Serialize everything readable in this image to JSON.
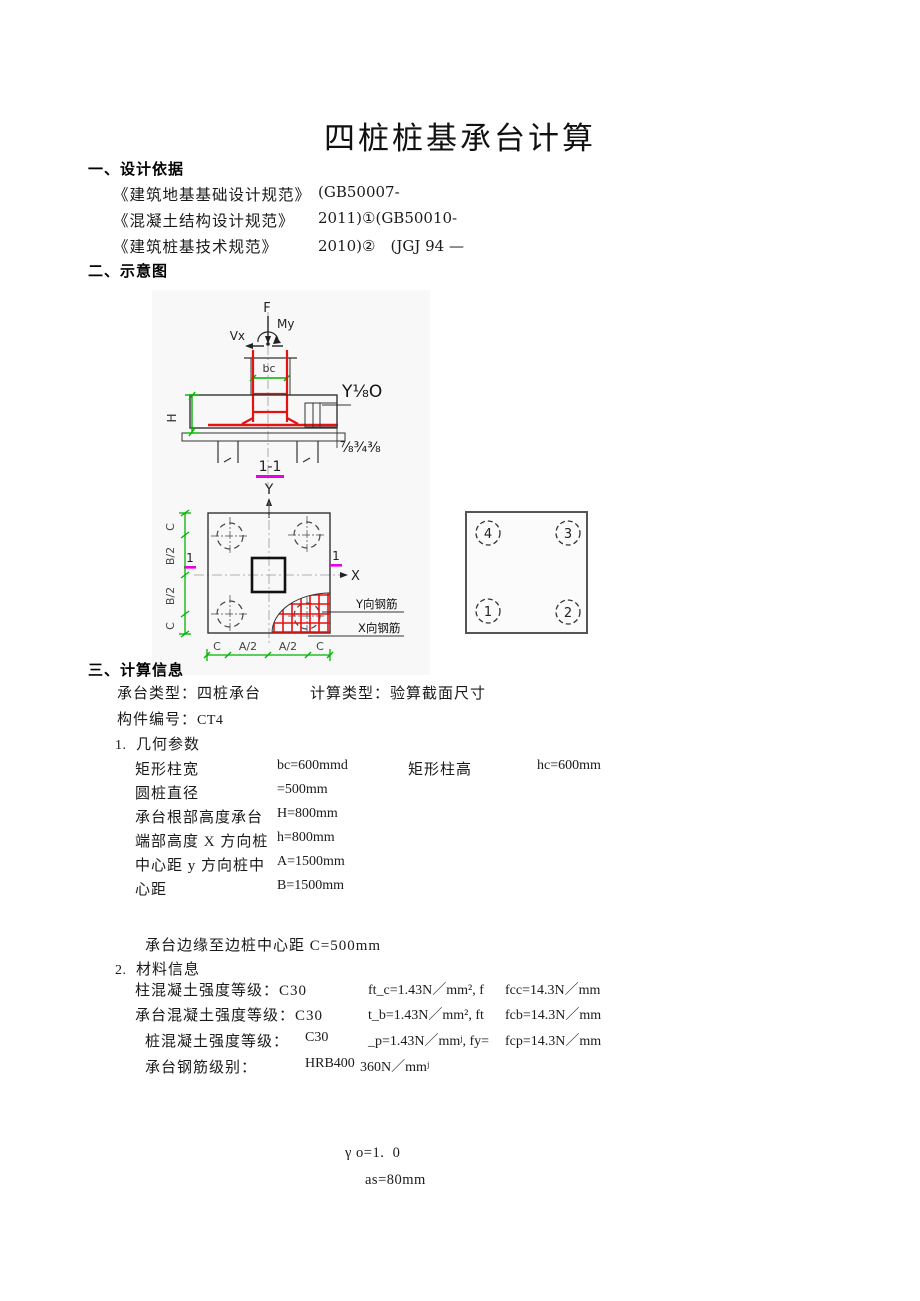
{
  "page": {
    "title": "四桩桩基承台计算"
  },
  "design_basis": {
    "heading": "一、设计依据",
    "references": [
      {
        "name": "《建筑地基基础设计规范》",
        "code": "(GB50007-"
      },
      {
        "name": "《混凝土结构设计规范》",
        "code": "2011)①(GB50010-"
      },
      {
        "name": "《建筑桩基技术规范》",
        "code": "2010)②　(JGJ 94 —"
      }
    ]
  },
  "schematic": {
    "heading": "二、示意图",
    "section_view": {
      "force": "F",
      "moment": "My",
      "shear": "Vx",
      "column_width": "bc",
      "cap_height": "H",
      "note_top": "Y⅛O",
      "note_bottom": "⅞¾⅜",
      "section_mark": "1-1",
      "axis_y": "Y"
    },
    "plan_view": {
      "axis_x": "X",
      "left_dims": [
        "C",
        "B/2",
        "B/2",
        "C"
      ],
      "bottom_dims": [
        "C",
        "A/2",
        "A/2",
        "C"
      ],
      "cut_mark_left": "1",
      "cut_mark_right": "1",
      "rebar_y": "Y向钢筋",
      "rebar_x": "X向钢筋"
    },
    "pile_layout": {
      "top_left": "4",
      "top_right": "3",
      "bottom_left": "1",
      "bottom_right": "2"
    }
  },
  "calc_info": {
    "heading": "三、计算信息",
    "cap_type_label": "承台类型：",
    "cap_type_value": "四桩承台",
    "calc_type_label": "计算类型：",
    "calc_type_value": "验算截面尺寸",
    "member_label": "构件编号：",
    "member_value": "CT4",
    "geometry": {
      "num": "1.",
      "title": "几何参数",
      "rows": [
        {
          "l1": "矩形柱宽",
          "v1": "bc=600mmd",
          "l2": "矩形柱高",
          "v2": "hc=600mm"
        },
        {
          "l1": "圆桩直径",
          "v1": "=500mm",
          "l2": "",
          "v2": ""
        },
        {
          "l1": "承台根部高度承台",
          "v1": "H=800mm",
          "l2": "",
          "v2": ""
        },
        {
          "l1": "端部高度 X 方向桩",
          "v1": "h=800mm",
          "l2": "",
          "v2": ""
        },
        {
          "l1": "中心距 y 方向桩中",
          "v1": "A=1500mm",
          "l2": "",
          "v2": ""
        },
        {
          "l1": "心距",
          "v1": "B=1500mm",
          "l2": "",
          "v2": ""
        }
      ],
      "edge_note": "承台边缘至边桩中心距 C=500mm"
    },
    "materials": {
      "num": "2.",
      "title": "材料信息",
      "rows": [
        {
          "label": "柱混凝土强度等级：C30",
          "value": "",
          "formula": "ft_c=1.43N／mm², f",
          "fval": "fcc=14.3N／mm"
        },
        {
          "label": "承台混凝土强度等级：C30",
          "value": "",
          "formula": "t_b=1.43N／mm², ft",
          "fval": "fcb=14.3N／mm"
        },
        {
          "label": "桩混凝土强度等级：",
          "value": "C30",
          "formula": "_p=1.43N／mmʲ, fy=",
          "fval": "fcp=14.3N／mm"
        },
        {
          "label": "承台钢筋级别：",
          "value": "HRB400",
          "formula": "360N／mmʲ",
          "fval": ""
        }
      ]
    },
    "gamma_line": "γ o=1.  0",
    "as_line": "as=80mm"
  },
  "colors": {
    "dim_green": "#00b400",
    "mark_magenta": "#e800e8",
    "rebar_red": "#e51212"
  }
}
